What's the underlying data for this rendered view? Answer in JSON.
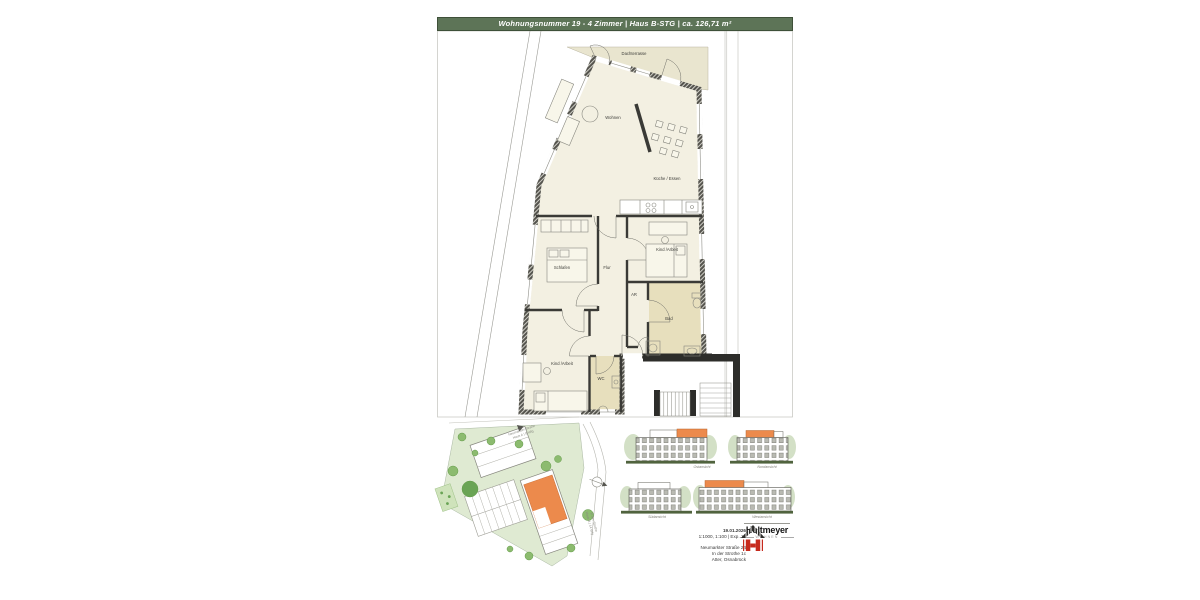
{
  "header": {
    "title": "Wohnungsnummer 19 - 4 Zimmer | Haus B-STG | ca. 126,71 m²"
  },
  "floorplan": {
    "rooms": [
      {
        "label": "Dachterrasse"
      },
      {
        "label": "Wohnen"
      },
      {
        "label": "Küche / Essen"
      },
      {
        "label": "Schlafen"
      },
      {
        "label": "Flur"
      },
      {
        "label": "Kind /Arbeit"
      },
      {
        "label": "AR"
      },
      {
        "label": "Bad"
      },
      {
        "label": "Kind /Arbeit"
      },
      {
        "label": "WC"
      }
    ]
  },
  "siteplan": {
    "label_top_line1": "Neumarkter Straße",
    "label_top_line2": "Haus A | 8 Wfg",
    "label_right_line1": "In der Strothe",
    "label_right_line2": "Haus B | 14 Wfg"
  },
  "elevations": [
    {
      "label": "Ostansicht"
    },
    {
      "label": "Nordansicht"
    },
    {
      "label": "Südansicht"
    },
    {
      "label": "Westansicht"
    }
  ],
  "info": {
    "date": "19.01.2026",
    "scale": "1:1000, 1:100 | Exp. 19",
    "address_line1": "Neumarkter Straße 24",
    "address_line2": "In der Strothe 1c",
    "address_line3": "Atter, Osnabrück"
  },
  "logo": {
    "name": "Holtmeyer",
    "subtitle": "WOHNEN"
  },
  "colors": {
    "header_green": "#5d7457",
    "highlight_orange": "#ec8a4c",
    "logo_red": "#c62a1d",
    "floor_cream": "#f3f0e2",
    "terrace_beige": "#e9e5cf",
    "bath_khaki": "#e7dfbd",
    "site_green": "#dfead2",
    "ground_olive": "#50633e"
  }
}
